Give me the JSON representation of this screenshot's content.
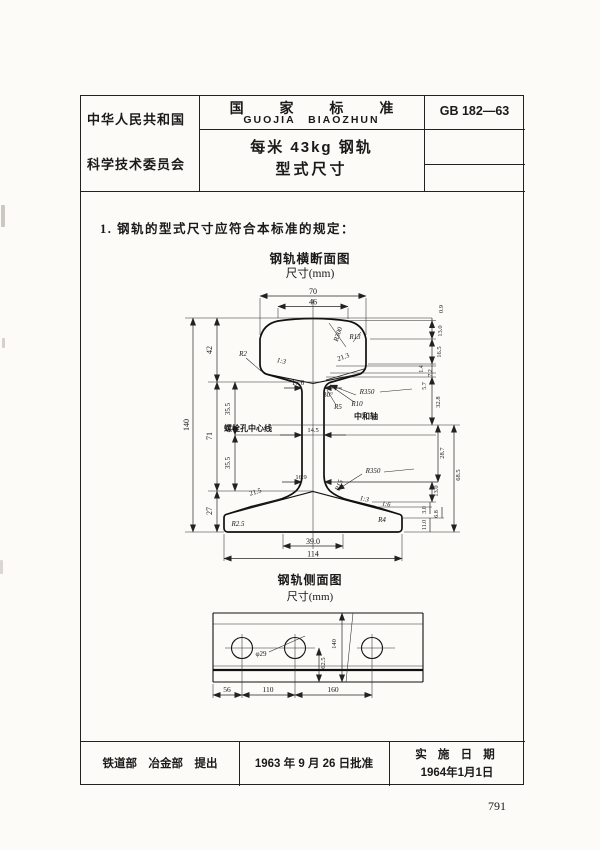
{
  "header": {
    "country_line1": "中华人民共和国",
    "country_line2": "科学技术委员会",
    "standard_label_cn": "国 家 标 准",
    "standard_label_pinyin": "GUOJIA BIAOZHUN",
    "title_line1": "每米 43kg 钢轨",
    "title_line2": "型式尺寸",
    "standard_code": "GB 182—63"
  },
  "body": {
    "clause_text": "1.  钢轨的型式尺寸应符合本标准的规定：",
    "figure1_title": "钢轨横断面图",
    "figure1_unit": "尺寸(mm)",
    "figure2_title": "钢轨侧面图",
    "figure2_unit": "尺寸(mm)"
  },
  "footer": {
    "proposed_by": "铁道部　冶金部　提出",
    "approval": "1963 年 9 月 26 日批准",
    "implementation_label": "实 施 日 期",
    "implementation_date": "1964年1月1日"
  },
  "page_number": "791",
  "cross_section": {
    "labels": [
      {
        "t": "70",
        "x": 133,
        "y": 9,
        "s": 8
      },
      {
        "t": "46",
        "x": 133,
        "y": 19.5,
        "s": 8
      },
      {
        "t": "0.9",
        "x": 263,
        "y": 24,
        "r": -90,
        "s": 6.5
      },
      {
        "t": "13.0",
        "x": 262,
        "y": 46,
        "r": -90,
        "s": 6.5
      },
      {
        "t": "16.5",
        "x": 261,
        "y": 67,
        "r": -90,
        "s": 6.5
      },
      {
        "t": "1.4",
        "x": 243,
        "y": 84,
        "r": -90,
        "s": 6
      },
      {
        "t": "7.2",
        "x": 252,
        "y": 88,
        "r": -90,
        "s": 6
      },
      {
        "t": "5.7",
        "x": 246,
        "y": 101,
        "r": -90,
        "s": 6
      },
      {
        "t": "32.8",
        "x": 260,
        "y": 117,
        "r": -90,
        "s": 6.5
      },
      {
        "t": "28.7",
        "x": 264,
        "y": 168,
        "r": -90,
        "s": 6.5
      },
      {
        "t": "68.5",
        "x": 280,
        "y": 190,
        "r": -90,
        "s": 6.5
      },
      {
        "t": "13.0",
        "x": 258,
        "y": 206,
        "r": -90,
        "s": 6.5
      },
      {
        "t": "3.0",
        "x": 246,
        "y": 225,
        "r": -90,
        "s": 6
      },
      {
        "t": "6.8",
        "x": 258,
        "y": 229,
        "r": -90,
        "s": 6
      },
      {
        "t": "11.0",
        "x": 246,
        "y": 240,
        "r": -90,
        "s": 6
      },
      {
        "t": "140",
        "x": 9,
        "y": 140,
        "r": -90,
        "s": 8
      },
      {
        "t": "42",
        "x": 32,
        "y": 65,
        "r": -90,
        "s": 8
      },
      {
        "t": "71",
        "x": 32,
        "y": 151,
        "r": -90,
        "s": 8
      },
      {
        "t": "35.5",
        "x": 50,
        "y": 124,
        "r": -90,
        "s": 7
      },
      {
        "t": "35.5",
        "x": 50,
        "y": 178,
        "r": -90,
        "s": 7
      },
      {
        "t": "27",
        "x": 32,
        "y": 226,
        "r": -90,
        "s": 8
      },
      {
        "t": "R2",
        "x": 63,
        "y": 71,
        "s": 7,
        "i": 1
      },
      {
        "t": "1:3",
        "x": 101,
        "y": 78,
        "r": 12,
        "s": 7,
        "i": 1
      },
      {
        "t": "R300",
        "x": 160,
        "y": 50,
        "r": -72,
        "s": 7,
        "i": 1
      },
      {
        "t": "R13",
        "x": 175,
        "y": 54,
        "s": 7,
        "i": 1
      },
      {
        "t": "21.3",
        "x": 164,
        "y": 74,
        "r": -20,
        "s": 7
      },
      {
        "t": "17.6",
        "x": 118,
        "y": 100,
        "s": 7
      },
      {
        "t": "30°",
        "x": 148,
        "y": 112,
        "s": 7
      },
      {
        "t": "R350",
        "x": 187,
        "y": 109,
        "s": 7,
        "i": 1
      },
      {
        "t": "R5",
        "x": 158,
        "y": 124,
        "s": 7,
        "i": 1
      },
      {
        "t": "R10",
        "x": 177,
        "y": 121,
        "s": 7,
        "i": 1
      },
      {
        "t": "中和轴",
        "x": 186,
        "y": 134,
        "s": 8,
        "b": 1
      },
      {
        "t": "螺栓孔中心线",
        "x": 68,
        "y": 146,
        "s": 8,
        "b": 1
      },
      {
        "t": "14.5",
        "x": 133,
        "y": 147,
        "s": 6.5
      },
      {
        "t": "16.9",
        "x": 121,
        "y": 194,
        "s": 6.5
      },
      {
        "t": "R350",
        "x": 193,
        "y": 188,
        "s": 7,
        "i": 1
      },
      {
        "t": "R15",
        "x": 161,
        "y": 201,
        "r": -70,
        "s": 7,
        "i": 1
      },
      {
        "t": "21.5",
        "x": 76,
        "y": 209,
        "r": -17,
        "s": 7
      },
      {
        "t": "1:3",
        "x": 184,
        "y": 216,
        "r": 11,
        "s": 7,
        "i": 1
      },
      {
        "t": "1:6",
        "x": 206,
        "y": 221,
        "r": 8,
        "s": 6.5,
        "i": 1
      },
      {
        "t": "R2.5",
        "x": 58,
        "y": 241,
        "s": 7,
        "i": 1
      },
      {
        "t": "R4",
        "x": 202,
        "y": 237,
        "s": 7,
        "i": 1
      },
      {
        "t": "39.0",
        "x": 133,
        "y": 259,
        "s": 8
      },
      {
        "t": "114",
        "x": 133,
        "y": 271.5,
        "s": 8
      }
    ]
  },
  "side_view": {
    "labels": [
      {
        "t": "φ29",
        "x": 66,
        "y": 56,
        "s": 7
      },
      {
        "t": "62.5",
        "x": 130,
        "y": 63,
        "r": -90,
        "s": 6.5
      },
      {
        "t": "140",
        "x": 141,
        "y": 44,
        "r": -90,
        "s": 6.5
      },
      {
        "t": "56",
        "x": 32,
        "y": 92,
        "s": 7.5
      },
      {
        "t": "110",
        "x": 73,
        "y": 92,
        "s": 7.5
      },
      {
        "t": "160",
        "x": 138,
        "y": 92,
        "s": 7.5
      }
    ]
  }
}
